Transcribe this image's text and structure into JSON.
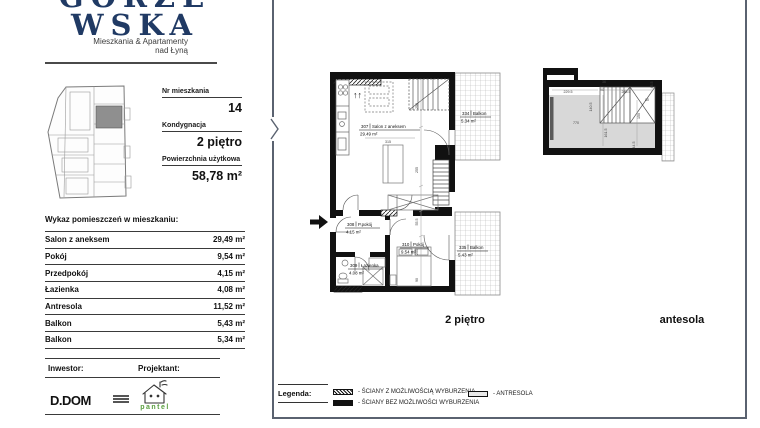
{
  "branding": {
    "logo_line1": "GORZE",
    "logo_line2": "WSKA",
    "tagline_line1": "Mieszkania & Apartamenty",
    "tagline_line2": "nad Łyną"
  },
  "unit": {
    "nr_label": "Nr mieszkania",
    "nr_value": "14",
    "floor_label": "Kondygnacja",
    "floor_value": "2 piętro",
    "area_label": "Powierzchnia użytkowa",
    "area_value": "58,78 m²"
  },
  "room_table": {
    "title": "Wykaz pomieszczeń w mieszkaniu:",
    "rows": [
      {
        "name": "Salon z aneksem",
        "area": "29,49 m²"
      },
      {
        "name": "Pokój",
        "area": "9,54 m²"
      },
      {
        "name": "Przedpokój",
        "area": "4,15 m²"
      },
      {
        "name": "Łazienka",
        "area": "4,08 m²"
      },
      {
        "name": "Antresola",
        "area": "11,52 m²"
      },
      {
        "name": "Balkon",
        "area": "5,43 m²"
      },
      {
        "name": "Balkon",
        "area": "5,34 m²"
      }
    ]
  },
  "footer": {
    "inwestor_label": "Inwestor:",
    "projektant_label": "Projektant:",
    "inwestor_logo_text": "D.DOM",
    "projektant_logo_text": "pantel"
  },
  "plan_main": {
    "caption": "2 piętro",
    "up_arrows": "↑↑",
    "rooms": [
      {
        "num": "307",
        "name": "Salon z aneksem",
        "area": "29.49 m²"
      },
      {
        "num": "308",
        "name": "P.pokój",
        "area": "4.15 m²"
      },
      {
        "num": "309",
        "name": "Łazienka",
        "area": "4.08 m²"
      },
      {
        "num": "310",
        "name": "Pokój",
        "area": "9.54 m²"
      },
      {
        "num": "334",
        "name": "Balkon",
        "area": "5.34 m²"
      },
      {
        "num": "335",
        "name": "Balkon",
        "area": "5.43 m²"
      }
    ],
    "dims": [
      "315",
      "250",
      "255",
      "55.5",
      "250",
      "90"
    ]
  },
  "plan_antresola": {
    "caption": "antesola",
    "dims": [
      "229.5",
      "770",
      "90",
      "36",
      "285.5",
      "80",
      "45.5",
      "140.5",
      "161.5",
      "150",
      "44.5"
    ]
  },
  "legend": {
    "label": "Legenda:",
    "items": [
      {
        "text": "- ŚCIANY Z MOŻLIWOŚCIĄ WYBURZENIA"
      },
      {
        "text": "- ŚCIANY BEZ MOŻLIWOŚCI WYBURZENIA"
      },
      {
        "text": "- ANTRESOLA"
      }
    ]
  },
  "colors": {
    "navy": "#203a64",
    "frame_gray": "#5a6270",
    "pantel_green": "#5a9e3f",
    "antresola_gray": "#d8d8d8"
  }
}
